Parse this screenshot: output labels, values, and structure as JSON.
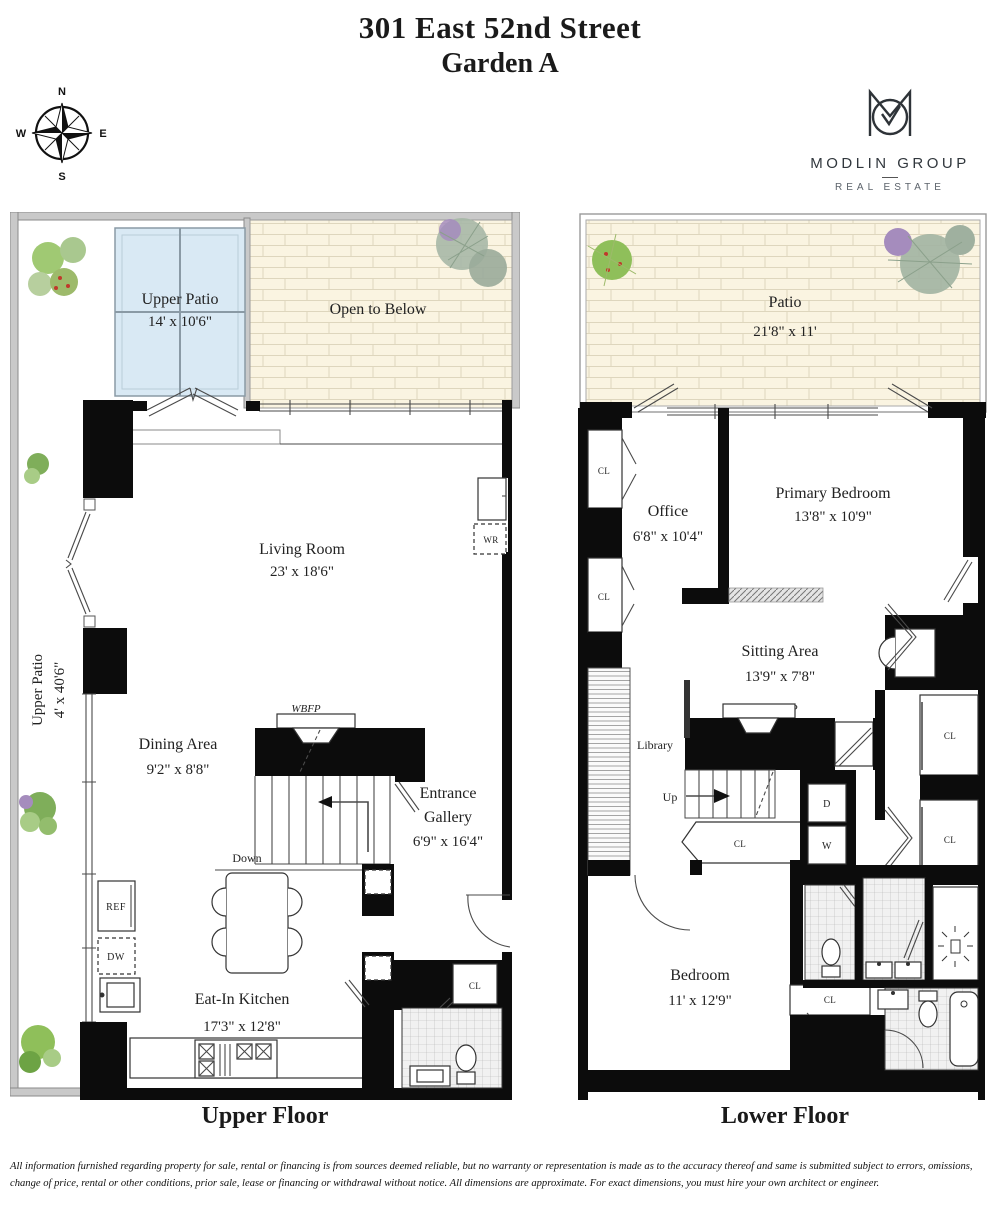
{
  "title": {
    "line1": "301 East 52nd Street",
    "line2": "Garden A"
  },
  "compass": {
    "n": "N",
    "e": "E",
    "s": "S",
    "w": "W"
  },
  "logo": {
    "name": "MODLIN GROUP",
    "tagline": "REAL ESTATE"
  },
  "abbr": {
    "cl": "CL",
    "wr": "WR",
    "ref": "REF",
    "dw": "DW",
    "d": "D",
    "w": "W",
    "wbfp": "WBFP",
    "up": "Up",
    "down": "Down",
    "library": "Library"
  },
  "upper_floor": {
    "label": "Upper Floor",
    "patio_top": {
      "name": "Upper Patio",
      "dims": "14' x 10'6\""
    },
    "open_to_below": {
      "name": "Open to Below"
    },
    "living_room": {
      "name": "Living Room",
      "dims": "23' x 18'6\""
    },
    "dining_area": {
      "name": "Dining Area",
      "dims": "9'2\" x 8'8\""
    },
    "entrance_gallery": {
      "line1": "Entrance",
      "line2": "Gallery",
      "dims": "6'9\" x 16'4\""
    },
    "kitchen": {
      "name": "Eat-In Kitchen",
      "dims": "17'3\" x 12'8\""
    },
    "patio_side": {
      "name": "Upper Patio",
      "dims": "4' x 40'6\""
    }
  },
  "lower_floor": {
    "label": "Lower Floor",
    "patio": {
      "name": "Patio",
      "dims": "21'8\" x 11'"
    },
    "office": {
      "name": "Office",
      "dims": "6'8\" x 10'4\""
    },
    "primary_bedroom": {
      "name": "Primary Bedroom",
      "dims": "13'8\" x 10'9\""
    },
    "sitting_area": {
      "name": "Sitting Area",
      "dims": "13'9\" x 7'8\""
    },
    "bedroom": {
      "name": "Bedroom",
      "dims": "11' x 12'9\""
    }
  },
  "disclaimer": {
    "line1": "All information furnished regarding property for sale, rental or financing is from sources deemed reliable, but no warranty or representation is made as to the accuracy thereof and same is submitted subject to errors, omissions,",
    "line2": "change of price, rental or other conditions, prior sale, lease or financing or withdrawal without notice. All dimensions are approximate. For exact dimensions, you must hire your own architect or engineer."
  },
  "colors": {
    "wall": "#0c0c0c",
    "patio_border": "#c9c9c9",
    "brick": "#faf4e1",
    "skylight": "#d9e9f4",
    "tile": "#f1f1f1",
    "plant_green": "#8fbf5a"
  }
}
